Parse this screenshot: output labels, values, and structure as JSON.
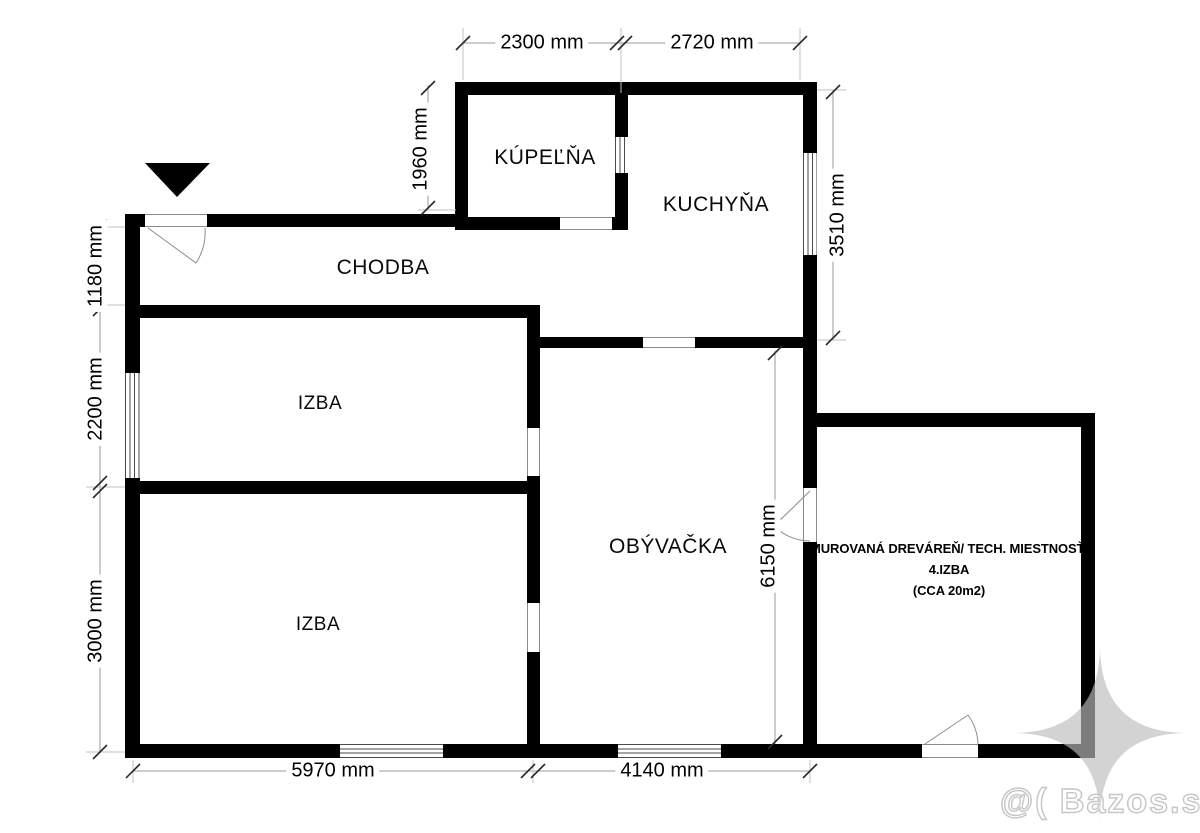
{
  "rooms": [
    {
      "name": "kupelna",
      "label": "KÚPEĽŇA"
    },
    {
      "name": "kuchyna",
      "label": "KUCHYŇA"
    },
    {
      "name": "chodba",
      "label": "CHODBA"
    },
    {
      "name": "izba-1",
      "label": "IZBA"
    },
    {
      "name": "izba-2",
      "label": "IZBA"
    },
    {
      "name": "obyvacka",
      "label": "OBÝVAČKA"
    }
  ],
  "annex_label": {
    "line1": "MUROVANÁ DREVÁREŇ/ TECH. MIESTNOSŤ/",
    "line2": "4.IZBA",
    "line3": "(CCA 20m2)"
  },
  "dimensions": {
    "top_left": "2300 mm",
    "top_right": "2720 mm",
    "bathroom_height": "1960 mm",
    "hall_height": "1180 mm",
    "room1_window": "2200 mm",
    "room2_height": "3000 mm",
    "kitchen_right": "3510 mm",
    "living_right": "6150 mm",
    "bottom_left": "5970 mm",
    "bottom_right": "4140 mm"
  },
  "watermark": {
    "text": "@( Bazos.sk"
  },
  "colors": {
    "wall": "#000000",
    "dimension_line": "#9a9a9a",
    "extension_line": "#c2c2c2",
    "tick": "#2a2a2a",
    "window_line": "#4a4a4a",
    "watermark_gray": "#bcbcbc"
  }
}
